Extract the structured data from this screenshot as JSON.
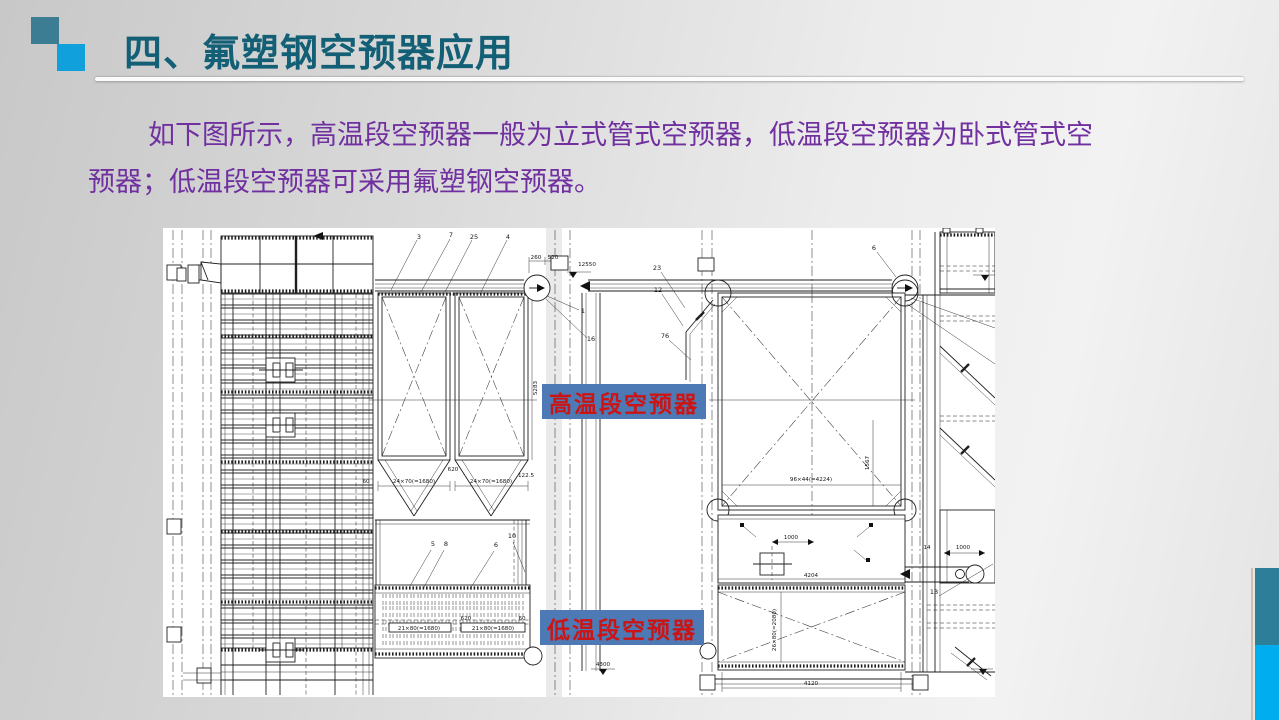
{
  "slide": {
    "header": {
      "title": "四、氟塑钢空预器应用"
    },
    "body": {
      "line1": "如下图所示，高温段空预器一般为立式管式空预器，低温段空预器为卧式管式空",
      "line2": "预器；低温段空预器可采用氟塑钢空预器。"
    }
  },
  "drawing": {
    "label_high_temp": "高温段空预器",
    "label_low_temp": "低温段空预器",
    "dims": [
      {
        "x": 373,
        "y": 31,
        "t": "260"
      },
      {
        "x": 390,
        "y": 31,
        "t": "520"
      },
      {
        "x": 424,
        "y": 38,
        "t": "12550"
      },
      {
        "x": 203,
        "y": 255,
        "t": "60"
      },
      {
        "x": 251,
        "y": 255,
        "t": "24×70(=1680)"
      },
      {
        "x": 328,
        "y": 255,
        "t": "24×70(=1680)"
      },
      {
        "x": 290,
        "y": 243,
        "t": "620"
      },
      {
        "x": 363,
        "y": 249,
        "t": "122.5"
      },
      {
        "x": 374,
        "y": 160,
        "t": "5283",
        "r": -90
      },
      {
        "x": 648,
        "y": 253,
        "t": "96×44(=4224)"
      },
      {
        "x": 706,
        "y": 235,
        "t": "1567",
        "r": -90
      },
      {
        "x": 628,
        "y": 311,
        "t": "1000"
      },
      {
        "x": 648,
        "y": 349,
        "t": "4204"
      },
      {
        "x": 613,
        "y": 402,
        "t": "26×80(=2080)",
        "r": -90
      },
      {
        "x": 648,
        "y": 457,
        "t": "4120"
      },
      {
        "x": 440,
        "y": 438,
        "t": "4300"
      },
      {
        "x": 256,
        "y": 402,
        "t": "21×80(=1680)"
      },
      {
        "x": 330,
        "y": 402,
        "t": "21×80(=1680)"
      },
      {
        "x": 303,
        "y": 392,
        "t": "620"
      },
      {
        "x": 359,
        "y": 392,
        "t": "60"
      },
      {
        "x": 800,
        "y": 321,
        "t": "1000"
      },
      {
        "x": 764,
        "y": 321,
        "t": "14"
      }
    ],
    "parts": [
      {
        "x": 256,
        "y": 11,
        "t": "3"
      },
      {
        "x": 288,
        "y": 9,
        "t": "7"
      },
      {
        "x": 311,
        "y": 11,
        "t": "25"
      },
      {
        "x": 345,
        "y": 11,
        "t": "4"
      },
      {
        "x": 420,
        "y": 85,
        "t": "1"
      },
      {
        "x": 428,
        "y": 113,
        "t": "16"
      },
      {
        "x": 494,
        "y": 42,
        "t": "23"
      },
      {
        "x": 495,
        "y": 64,
        "t": "12"
      },
      {
        "x": 502,
        "y": 110,
        "t": "76"
      },
      {
        "x": 711,
        "y": 22,
        "t": "6"
      },
      {
        "x": 270,
        "y": 318,
        "t": "5"
      },
      {
        "x": 283,
        "y": 318,
        "t": "8"
      },
      {
        "x": 333,
        "y": 319,
        "t": "6"
      },
      {
        "x": 349,
        "y": 310,
        "t": "10"
      },
      {
        "x": 771,
        "y": 366,
        "t": "13"
      }
    ]
  },
  "colors": {
    "title": "#135f76",
    "body_text": "#7030a0",
    "accent_square_teal": "#3c7d93",
    "accent_square_blue": "#10a1dc",
    "label_box": "#4d7ab5",
    "label_text": "#cb1515",
    "edge_bar_teal": "#2d7e99",
    "edge_bar_blue": "#00adef"
  }
}
